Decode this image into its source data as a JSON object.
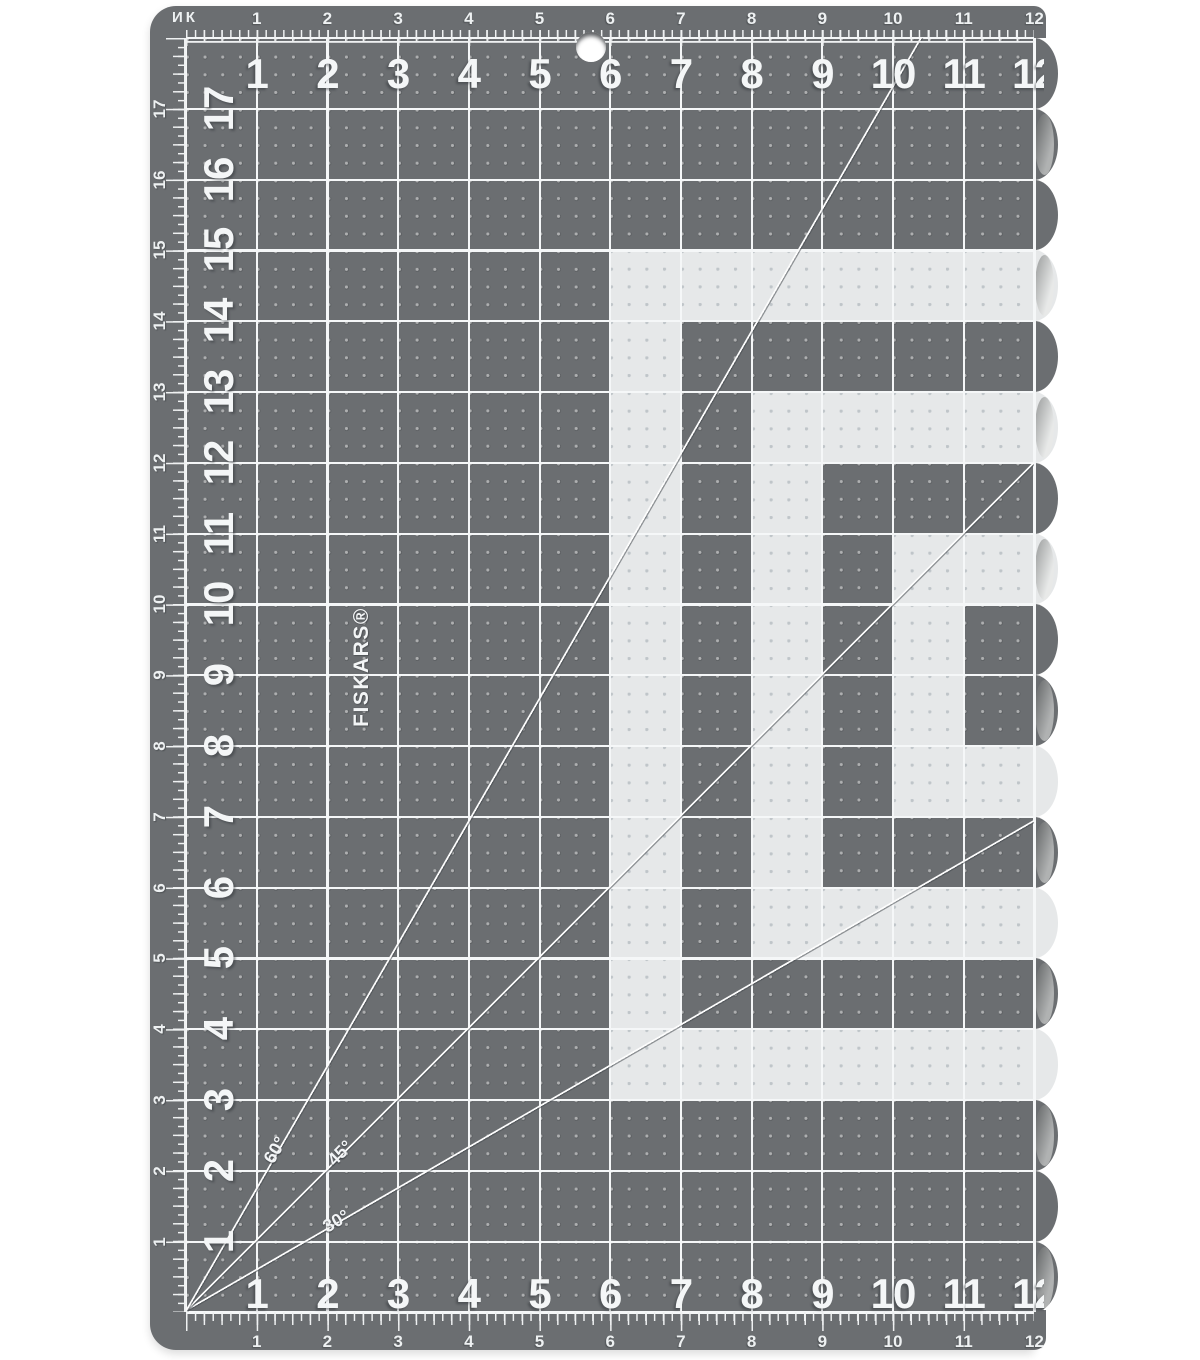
{
  "image_type": "product-photo-cutting-mat",
  "background_color": "#ffffff",
  "mat": {
    "brand": "FISKARS®",
    "corner_marking": "ИК",
    "colors": {
      "mat_dark": "#6b6e71",
      "cell_white": "#e6e8e9",
      "grid_line": "#f5f7f8",
      "tick": "#eff1f2",
      "number": "#f4f6f7",
      "dot_on_dark": "#ffffff",
      "dot_on_white": "#bfc5c9",
      "curl_shade_dark": "#9b9d9c",
      "curl_shade_light": "#e9eae8"
    },
    "grid": {
      "columns": 12,
      "rows": 18,
      "cell_w": 70.7,
      "cell_h": 70.8
    },
    "column_numbers": [
      "1",
      "2",
      "3",
      "4",
      "5",
      "6",
      "7",
      "8",
      "9",
      "10",
      "11",
      "12"
    ],
    "row_numbers": [
      "17",
      "16",
      "15",
      "14",
      "13",
      "12",
      "11",
      "10",
      "9",
      "8",
      "7",
      "6",
      "5",
      "4",
      "3",
      "2",
      "1"
    ],
    "tiny_column_numbers": [
      "1",
      "2",
      "3",
      "4",
      "5",
      "6",
      "7",
      "8",
      "9",
      "10",
      "11",
      "12"
    ],
    "tiny_row_numbers": [
      "17",
      "16",
      "15",
      "14",
      "13",
      "12",
      "11",
      "10",
      "9",
      "8",
      "7",
      "6",
      "5",
      "4",
      "3",
      "2",
      "1"
    ],
    "angle_labels": [
      {
        "text": "60°",
        "angle": 60
      },
      {
        "text": "45°",
        "angle": 45
      },
      {
        "text": "30°",
        "angle": 30
      }
    ],
    "diagonal_angles": [
      30,
      45,
      60
    ],
    "white_cells": {
      "3": [
        6,
        7,
        8,
        9,
        10,
        11
      ],
      "4": [
        6
      ],
      "5": [
        6,
        8,
        9,
        10,
        11
      ],
      "6": [
        6,
        8
      ],
      "7": [
        6,
        8,
        10,
        11
      ],
      "8": [
        6,
        8,
        10
      ],
      "9": [
        6,
        8,
        10
      ],
      "10": [
        6,
        8,
        10,
        11
      ],
      "11": [
        6,
        8
      ],
      "12": [
        6,
        8,
        9,
        10,
        11
      ],
      "13": [
        6
      ],
      "14": [
        6,
        7,
        8,
        9,
        10,
        11
      ]
    },
    "white_edge_rows": [
      3,
      5,
      7,
      10,
      12,
      14
    ],
    "hanging_hole": true
  }
}
